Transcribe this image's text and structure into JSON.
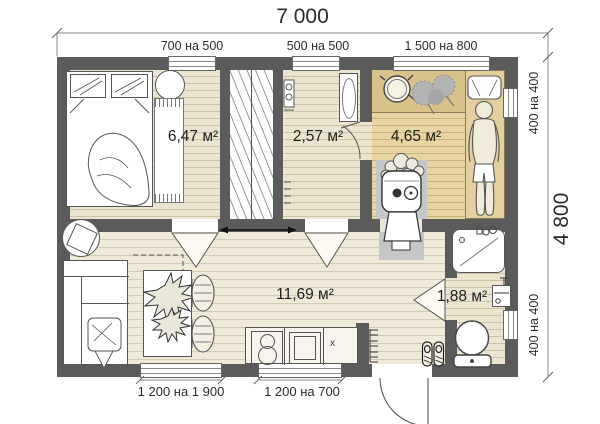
{
  "plan": {
    "overall": {
      "width_label": "7 000",
      "depth_label": "4 800"
    },
    "windows": {
      "top": [
        {
          "label": "700 на 500"
        },
        {
          "label": "500 на 500"
        },
        {
          "label": "1 500 на 800"
        }
      ],
      "right": [
        {
          "label": "400 на 400"
        },
        {
          "label": "400 на 400"
        }
      ],
      "bottom": [
        {
          "label": "1 200 на 1 900"
        },
        {
          "label": "1 200 на 700"
        }
      ]
    },
    "rooms": {
      "bedroom": {
        "area_label": "6,47 м²"
      },
      "washroom": {
        "area_label": "2,57 м²"
      },
      "sauna": {
        "area_label": "4,65 м²"
      },
      "living_kitchen": {
        "area_label": "11,69 м²"
      },
      "bathroom": {
        "area_label": "1,88 м²"
      }
    },
    "kitchen": {
      "counter_mark": "x"
    },
    "colors": {
      "wall": "#5b5b5b",
      "floor_beige": "#ebe5cf",
      "floor_living": "#efe9d7",
      "sauna_floor": "#e7d5a2",
      "sauna_bench": "#d7c28a",
      "hearth_gray": "#c6c6c6",
      "outline": "#555555",
      "background": "#ffffff"
    }
  }
}
